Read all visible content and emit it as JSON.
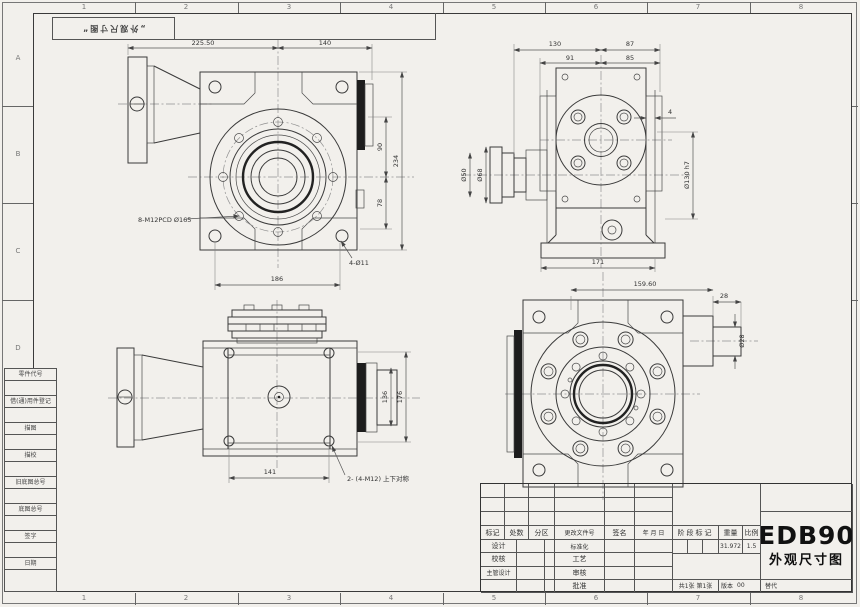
{
  "sheet": {
    "zone_cols": [
      "1",
      "2",
      "3",
      "4",
      "5",
      "6",
      "7",
      "8"
    ],
    "zone_rows": [
      "A",
      "B",
      "C",
      "D"
    ],
    "stamp": "„外观尺寸图“"
  },
  "margin_labels": [
    "零件代号",
    "借(通)用件登记",
    "描图",
    "描校",
    "旧底图总号",
    "底图总号",
    "签字",
    "日期"
  ],
  "views": {
    "front": {
      "dims": {
        "w1": "225.50",
        "w2": "140",
        "h1": "90",
        "h2": "78",
        "h_total": "234",
        "bottom": "186"
      },
      "notes": {
        "bolts": "8-M12PCD Ø165",
        "holes": "4-Ø11"
      }
    },
    "side": {
      "dims": {
        "t1": "130",
        "t2": "87",
        "t3": "91",
        "t4": "85",
        "d_outer": "Ø68",
        "d_inner": "Ø50",
        "d_spigot": "Ø130 h7",
        "plate": "4",
        "bottom": "171"
      }
    },
    "top": {
      "dims": {
        "bottom": "141",
        "inner": "136",
        "outer": "176"
      },
      "notes": {
        "sym": "2- (4-M12) 上下对称"
      }
    },
    "rear": {
      "dims": {
        "w": "159.60",
        "shaft_len": "28",
        "shaft_dia": "Ø28"
      }
    }
  },
  "title_block": {
    "rev_headers": [
      "标记",
      "处数",
      "分区",
      "更改文件号",
      "签名",
      "年 月 日"
    ],
    "roles": {
      "design": "设计",
      "check": "校核",
      "chief": "主管设计",
      "standard": "标准化",
      "process": "工艺",
      "audit": "审核",
      "approve": "批准"
    },
    "stage_label": "阶段标记",
    "weight_label": "重量",
    "scale_label": "比例",
    "weight": "31.972",
    "scale": "1.5",
    "model": "EDB90",
    "doc_title": "外观尺寸图",
    "sheet_info": "共1张 第1张",
    "version_label": "版本",
    "version": "00",
    "replace_label": "替代"
  }
}
